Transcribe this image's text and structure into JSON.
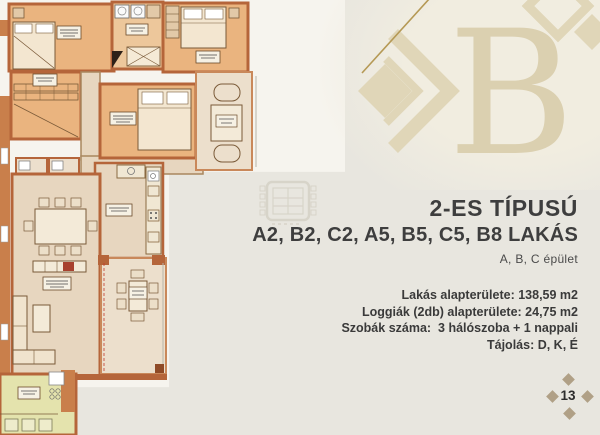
{
  "page": {
    "background_color": "#e8e6df",
    "paper_color": "#f6f4ee"
  },
  "header": {
    "title_line1": "2-ES TÍPUSÚ",
    "title_line2": "A2, B2, C2, A5, B5, C5, B8 LAKÁS",
    "building_line": "A, B, C épület"
  },
  "details": {
    "lines": [
      "Lakás alapterülete: 138,59 m2",
      "Loggiák (2db) alapterülete: 24,75 m2",
      "Szobák száma:  3 hálószoba + 1 nappali",
      "Tájolás: D, K, É"
    ]
  },
  "logo": {
    "letter": "B",
    "color": "#ded4b6",
    "accent_line_color": "#b59955"
  },
  "floorplan": {
    "wall_color": "#b5653a",
    "room_fill_color": "#eab47f",
    "floor_color": "#e7d6bf",
    "loggia_floor_color": "#ecdfcc",
    "neighbor_unit_color": "#e4e3ad",
    "rooms": [
      "bedroom-1",
      "bathroom",
      "bedroom-2",
      "dressing-room",
      "hall",
      "bedroom-3",
      "loggia-1",
      "wc-1",
      "wc-2",
      "kitchen",
      "living-dining",
      "loggia-2",
      "neighbor-unit"
    ]
  },
  "page_marker": {
    "number": "13",
    "diamond_color": "#b0a086"
  }
}
